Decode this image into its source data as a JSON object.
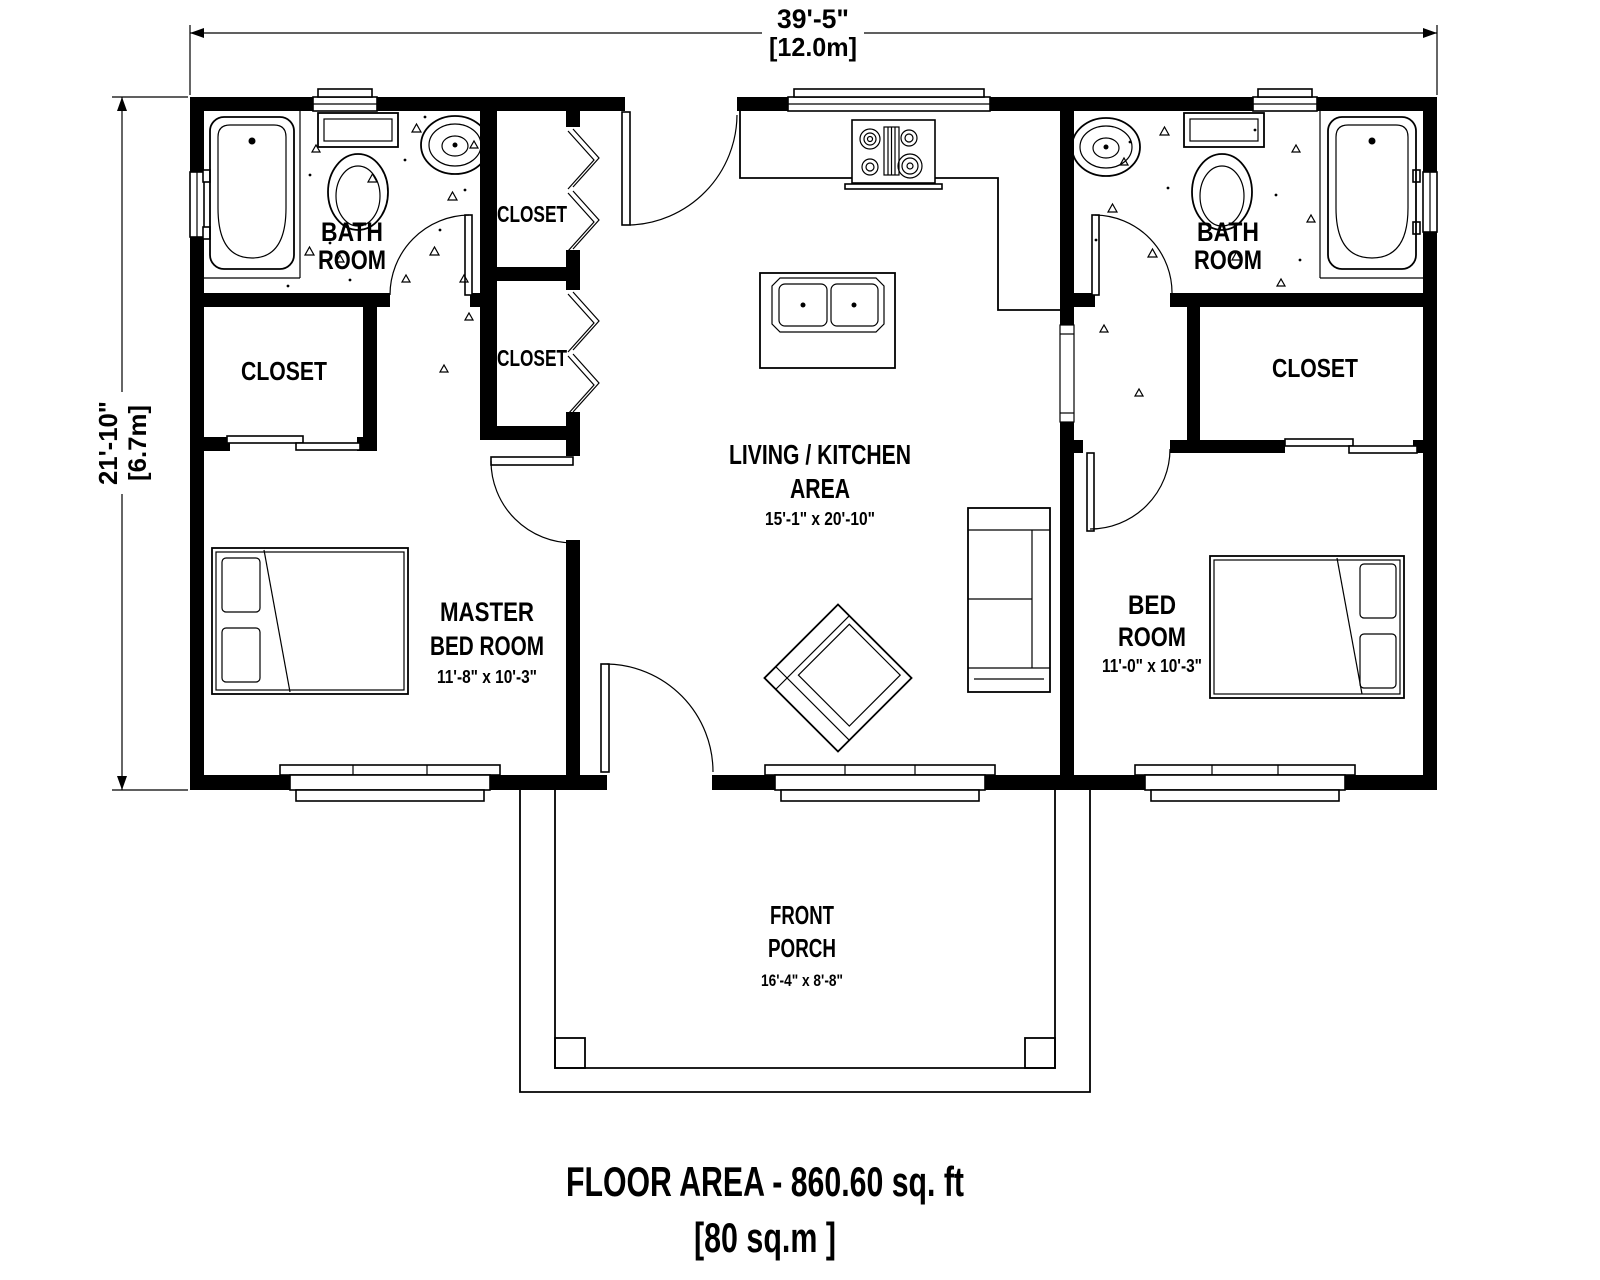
{
  "dimensions": {
    "width_ft": "39'-5\"",
    "width_m": "[12.0m]",
    "height_ft": "21'-10\"",
    "height_m": "[6.7m]"
  },
  "rooms": {
    "bath_left": {
      "line1": "BATH",
      "line2": "ROOM"
    },
    "bath_right": {
      "line1": "BATH",
      "line2": "ROOM"
    },
    "closet_hall_upper": {
      "label": "CLOSET"
    },
    "closet_hall_lower": {
      "label": "CLOSET"
    },
    "closet_master": {
      "label": "CLOSET"
    },
    "closet_bedroom": {
      "label": "CLOSET"
    },
    "master_bedroom": {
      "line1": "MASTER",
      "line2": "BED ROOM",
      "dims": "11'-8\" x 10'-3\""
    },
    "living_kitchen": {
      "line1": "LIVING / KITCHEN",
      "line2": "AREA",
      "dims": "15'-1\" x 20'-10\""
    },
    "bedroom": {
      "line1": "BED",
      "line2": "ROOM",
      "dims": "11'-0\" x 10'-3\""
    },
    "front_porch": {
      "line1": "FRONT",
      "line2": "PORCH",
      "dims": "16'-4\" x 8'-8\""
    }
  },
  "footer": {
    "title": "FLOOR AREA - 860.60 sq. ft",
    "subtitle": "[80 sq.m ]"
  },
  "colors": {
    "ink": "#000000",
    "paper": "#ffffff"
  }
}
